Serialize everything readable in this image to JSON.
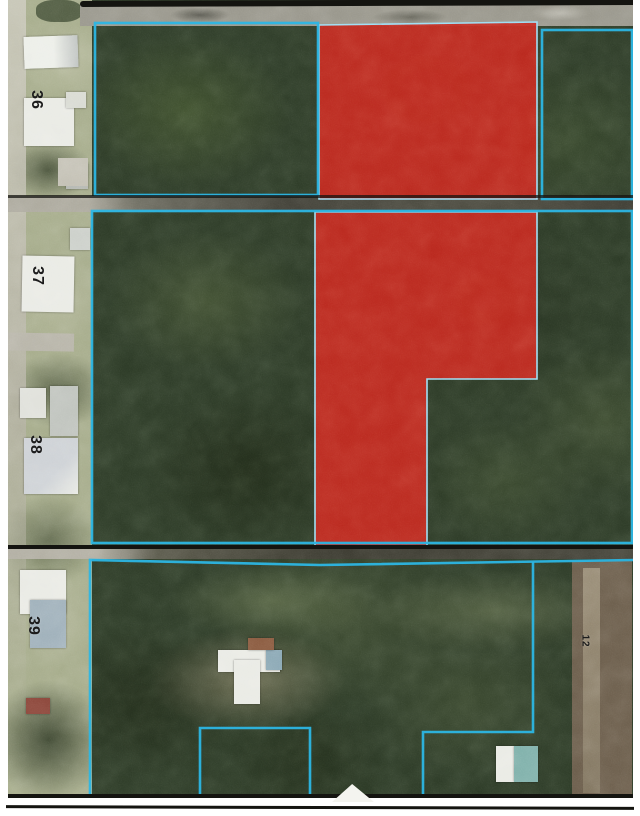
{
  "map": {
    "kind": "aerial-parcel-map",
    "colors": {
      "highlight_red": "#c3271e",
      "highlight_edge": "#9adcf2",
      "boundary_cyan": "#2cb6e4",
      "ink_black": "#141410",
      "page_white": "#ffffff"
    },
    "parcel_labels": [
      {
        "text": "36",
        "x": 26,
        "y": 92,
        "size": 16
      },
      {
        "text": "37",
        "x": 27,
        "y": 268,
        "size": 16
      },
      {
        "text": "38",
        "x": 25,
        "y": 437,
        "size": 16
      },
      {
        "text": "39",
        "x": 23,
        "y": 618,
        "size": 16
      },
      {
        "text": "12",
        "x": 578,
        "y": 636,
        "size": 10
      }
    ],
    "highlight_parcels": [
      {
        "name": "highlight-parcel-north",
        "points": "319,25 537,22 537,199 319,199"
      },
      {
        "name": "highlight-parcel-south",
        "points": "315,212 537,212 537,379 427,379 427,546 315,546"
      }
    ],
    "boundaries": {
      "rects": [
        {
          "name": "parcel-36-block-boundary",
          "x": 95,
          "y": 23,
          "w": 223,
          "h": 172
        },
        {
          "name": "parcel-northeast-boundary",
          "x": 542,
          "y": 30,
          "w": 90,
          "h": 169
        },
        {
          "name": "parcel-middle-block-boundary",
          "x": 92,
          "y": 211,
          "w": 540,
          "h": 332
        }
      ],
      "polylines": [
        {
          "name": "bottom-block-outline",
          "points": "90,798 90,560 320,565 634,560"
        },
        {
          "name": "bottom-inner-east-boundary",
          "points": "533,562 533,732 423,732 423,798"
        },
        {
          "name": "bottom-inner-parcel-boundary",
          "points": "200,798 200,728 310,728 310,798"
        }
      ]
    }
  }
}
